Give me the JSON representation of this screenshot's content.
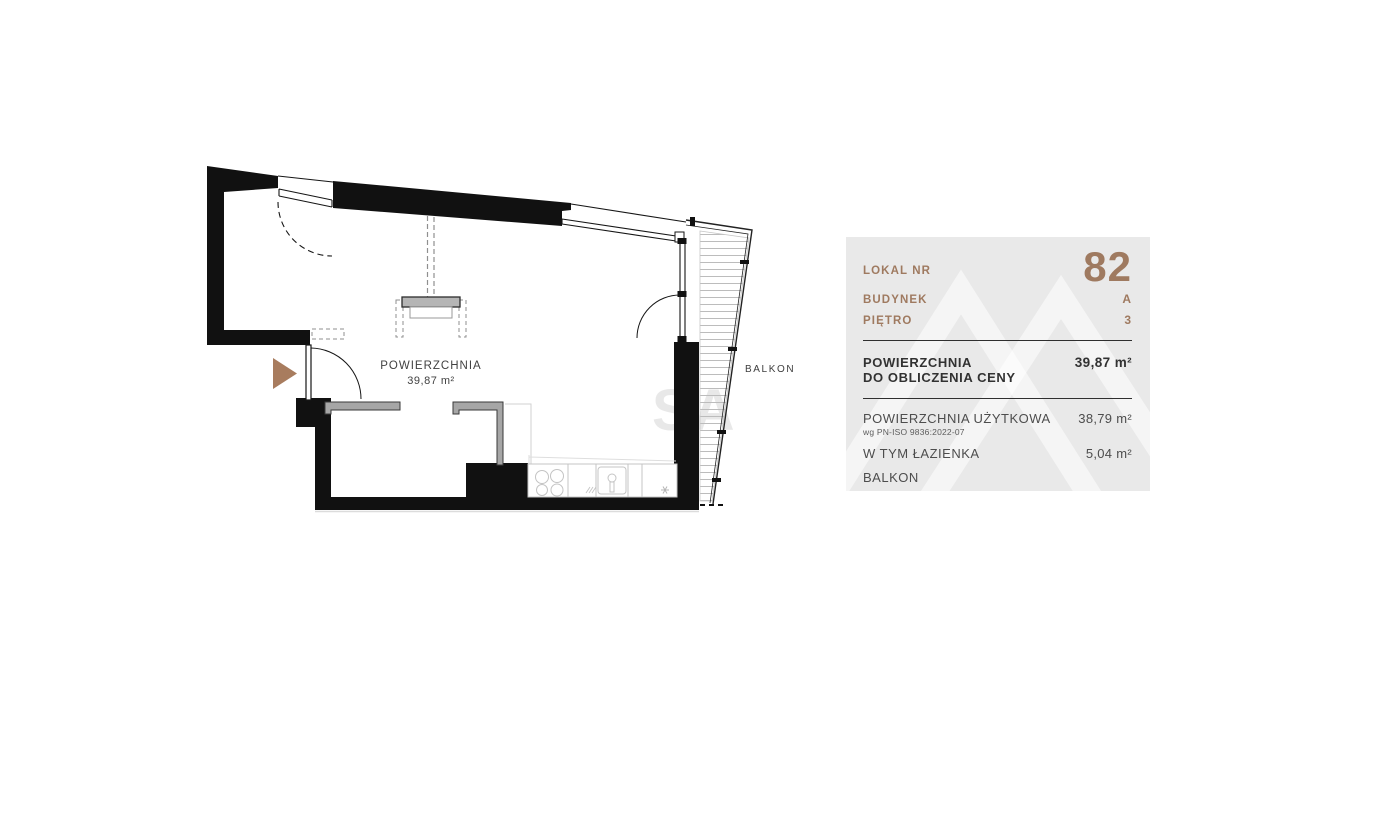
{
  "plan": {
    "area_label": "POWIERZCHNIA",
    "area_value": "39,87 m²",
    "balcony_label": "BALKON",
    "watermark": "SA"
  },
  "panel": {
    "accent_color": "#9f7a60",
    "background_color": "#e9e9e9",
    "rows_top": [
      {
        "label": "LOKAL NR",
        "value": "82"
      },
      {
        "label": "BUDYNEK",
        "value": "A"
      },
      {
        "label": "PIĘTRO",
        "value": "3"
      }
    ],
    "price_area": {
      "label_line1": "POWIERZCHNIA",
      "label_line2": "DO OBLICZENIA CENY",
      "value": "39,87 m²"
    },
    "details": [
      {
        "label": "POWIERZCHNIA UŻYTKOWA",
        "sublabel": "wg PN-ISO 9836:2022-07",
        "value": "38,79 m²"
      },
      {
        "label": "W TYM ŁAZIENKA",
        "sublabel": "",
        "value": "5,04 m²"
      },
      {
        "label": "BALKON",
        "sublabel": "",
        "value": ""
      }
    ]
  }
}
